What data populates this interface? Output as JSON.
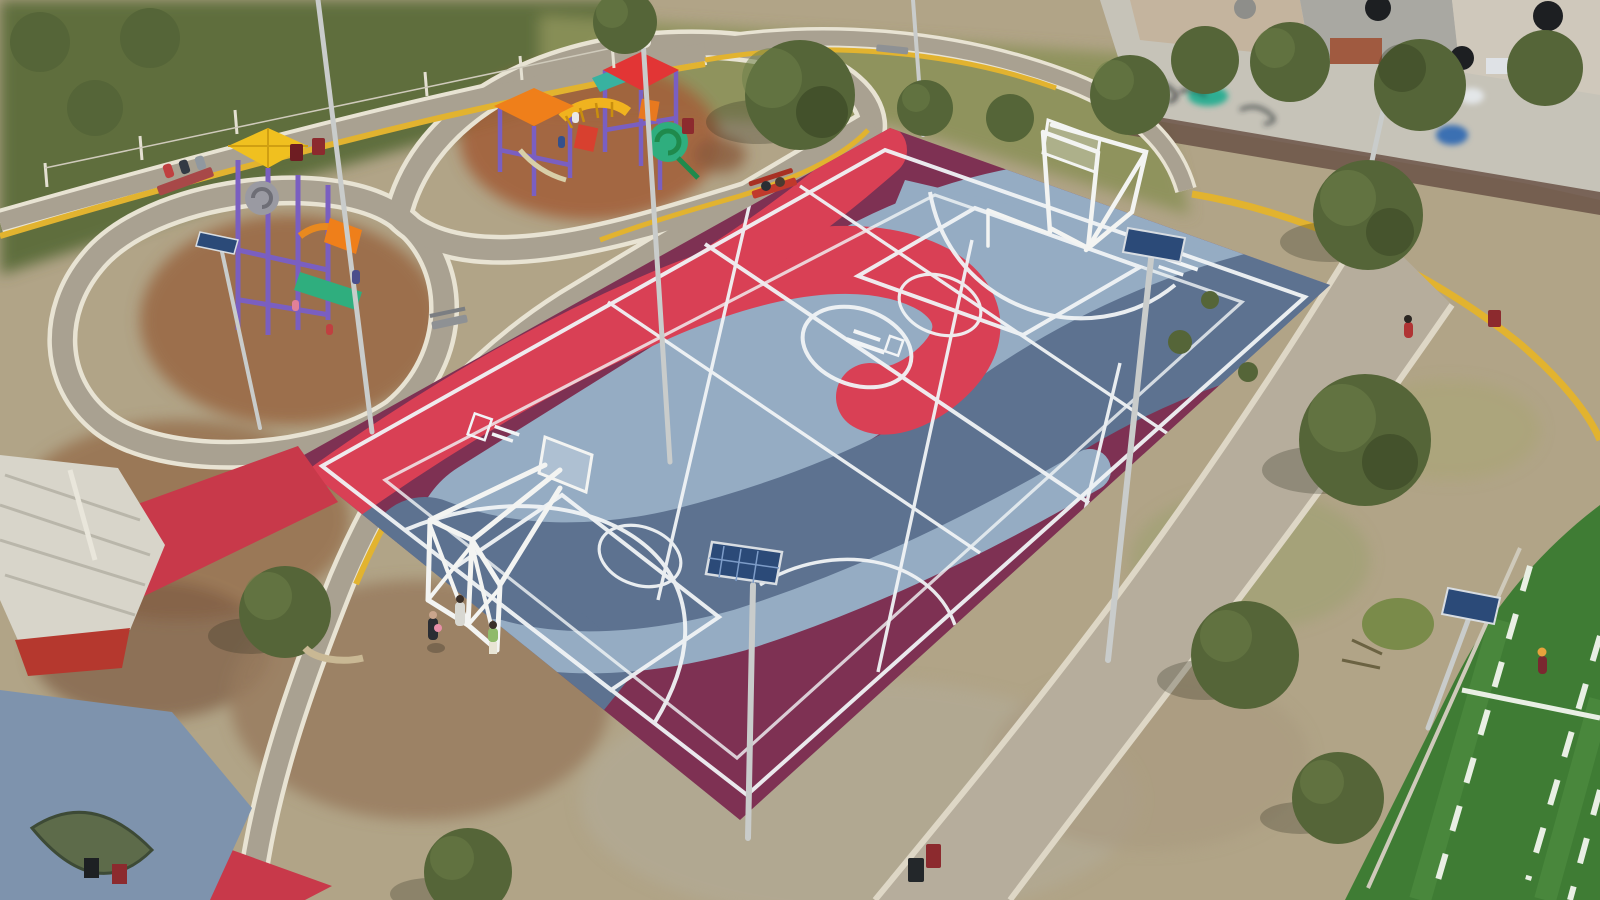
{
  "scene": {
    "type": "aerial-drone-photograph",
    "description": "Aerial view of a public park in warm late-afternoon light: a large multi-sport court painted in maroon, bright red and two blue-gray tones with white basketball, volleyball and futsal markings; two white steel goal/backboard structures; two playgrounds with purple frames and yellow, orange and red pyramid roofs; looping concrete walking paths edged in white and yellow; a red painted walkway to a small corrugated-roof kiosk; a blue-gray plaza slab with a leaf-shaped planter; a corner of green artificial turf with white dashed markings; solar LED light poles; dry grass, dirt patches, scattered trees; graffiti wall and rooftops with water tanks beyond the park fence.",
    "people": [
      "three people seated on a red bench by the upper-left path",
      "children playing on both playground structures",
      "three teenagers standing at the lower-left corner of the court",
      "person in red walking on the gravel path at right",
      "player in maroon standing on the turf field at lower right",
      "two people on the red bench beside the court"
    ],
    "objects": [
      "multi-sport court",
      "basketball goal north",
      "basketball truss goal south-west",
      "playground left",
      "playground central",
      "walking path loops",
      "gravel path",
      "turf soccer field corner",
      "kiosk",
      "plaza slab",
      "leaf planter",
      "solar light poles",
      "benches",
      "trash barrels",
      "graffiti wall",
      "water tanks",
      "trees",
      "wire fence posts"
    ]
  },
  "colors": {
    "grass_dry": "#b1a487",
    "grass_lush": "#5e6e3c",
    "dirt_brown": "#96714f",
    "gravel": "#b6ad9c",
    "path_concrete": "#a9a191",
    "path_curb_white": "#e8e3d3",
    "curb_yellow": "#e2b32f",
    "court_maroon": "#7e3153",
    "court_red": "#d94055",
    "court_blue_light": "#95acc3",
    "court_blue_dark": "#5d7290",
    "court_line": "#f1f4f6",
    "white_structure": "#f3f4f2",
    "turf_green": "#3f7c34",
    "turf_line": "#e9efe4",
    "red_walkway": "#c8394a",
    "kiosk_roof": "#d8d5ca",
    "plaza_blue": "#7e93ad",
    "playground_purple": "#7a5fc1",
    "roof_yellow": "#f0c01f",
    "roof_orange": "#ef7f1a",
    "roof_red": "#e23535",
    "slide_green": "#2fae7e",
    "solar_panel": "#2b4a78",
    "pole_silver": "#c9cccb",
    "wall_light": "#c6c3b8",
    "graffiti_teal": "#2fae93",
    "tree_green": "#556538",
    "bench_red": "#c0392b",
    "bench_gray": "#8e9194",
    "bin_red": "#8c2a2e"
  }
}
